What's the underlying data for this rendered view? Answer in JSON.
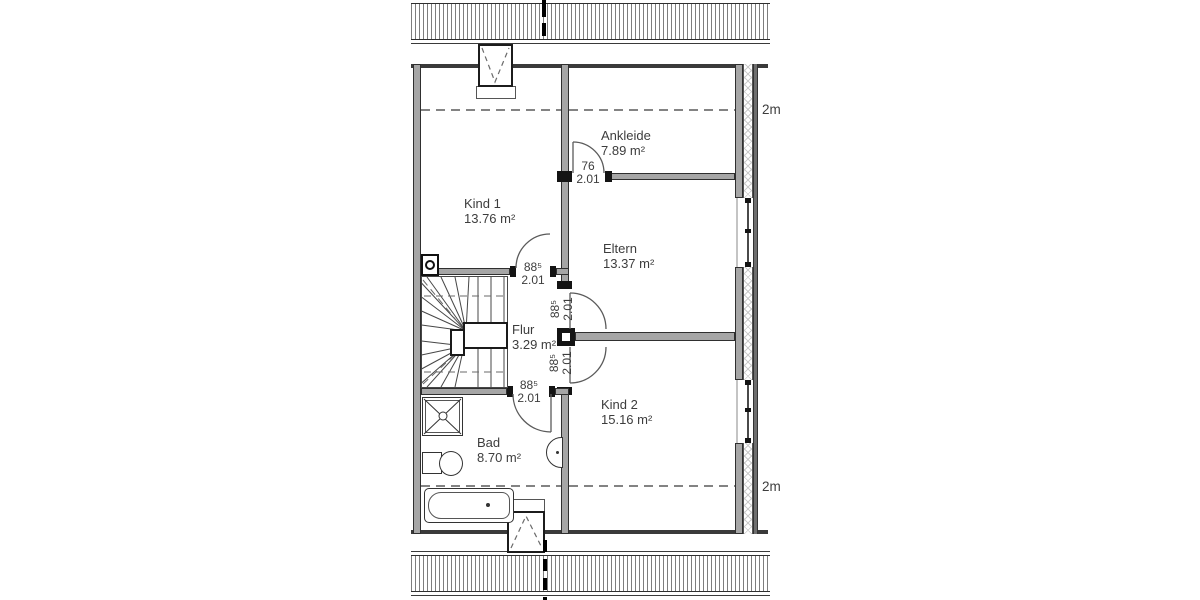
{
  "plan": {
    "title": "Dachgeschoss Grundriss",
    "rooms": [
      {
        "name": "Kind 1",
        "area": "13.76 m²"
      },
      {
        "name": "Ankleide",
        "area": "7.89 m²"
      },
      {
        "name": "Eltern",
        "area": "13.37 m²"
      },
      {
        "name": "Flur",
        "area": "3.29 m²"
      },
      {
        "name": "Kind 2",
        "area": "15.16 m²"
      },
      {
        "name": "Bad",
        "area": "8.70 m²"
      }
    ],
    "doors": [
      {
        "room": "Ankleide",
        "width": "76",
        "height": "2.01"
      },
      {
        "room": "Kind 1",
        "width": "88⁵",
        "height": "2.01"
      },
      {
        "room": "Eltern",
        "width": "88⁵",
        "height": "2.01"
      },
      {
        "room": "Kind 2",
        "width": "88⁵",
        "height": "2.01"
      },
      {
        "room": "Bad",
        "width": "88⁵",
        "height": "2.01"
      }
    ],
    "height_markers": {
      "top": "2m",
      "bottom": "2m"
    },
    "colors": {
      "wall_fill": "#a6a6a6",
      "line": "#2f2f2f",
      "text": "#3d3d3d"
    }
  }
}
